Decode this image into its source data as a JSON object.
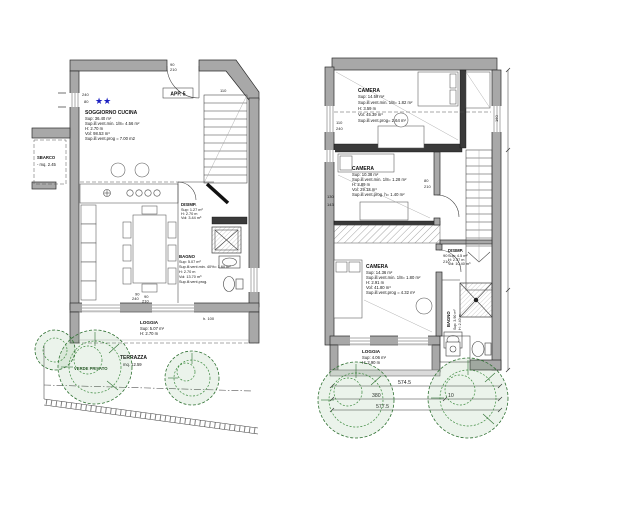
{
  "plan_title": "floor-plan",
  "left_unit": {
    "app_label": "APP. 5",
    "stars": "★★",
    "sbarco": {
      "title": "SBARCO",
      "line": "- mq. 2.45"
    },
    "soggiorno": {
      "title": "SOGGIORNO CUCINA",
      "stats": [
        "Sup: 36.40 m²",
        "Sup.ill.vent.min. 1/8= 4.56 m²",
        "H: 2.70 m",
        "Vol: 98.53 m³",
        "Sup.ill.vent.prog = 7.00 m2"
      ]
    },
    "disimp": {
      "title": "DISIMP.",
      "stats": [
        "Sup: 1.27 m²",
        "H: 2.70 m",
        "Vol: 3.44 m³"
      ]
    },
    "bagno": {
      "title": "BAGNO",
      "stats": [
        "Sup: 5.07 m²",
        "Sup.ill.vent.min. 40%= 1.60 m²",
        "H: 2.70 m",
        "Vol: 13.70 m³",
        "Sup.ill.vent.prog."
      ]
    },
    "loggia": {
      "title": "LOGGIA",
      "stats": [
        "Sup: 5.07 m²",
        "H: 2.70 m"
      ]
    },
    "terrazza": {
      "title": "TERRAZZA",
      "line": "mq. 12.59"
    },
    "verde": "VERDE PRIVATO",
    "dims": {
      "w240": "240",
      "w80": "80",
      "door_w": "90",
      "door_h": "210",
      "stair": "110",
      "win_a": "240",
      "win_b": "90",
      "table_w": "90",
      "table_l": "210",
      "h100": "h. 100"
    }
  },
  "right_unit": {
    "camera_top": {
      "title": "CAMERA",
      "stats": [
        "Sup: 14.59 m²",
        "Sup.ill.vent.min. 1/8= 1.82 m²",
        "H: 3.59 m",
        "Vol: 45.39 m³",
        "Sup.ill.vent.prog= 2.64 m²"
      ]
    },
    "camera_mid": {
      "title": "CAMERA",
      "stats": [
        "Sup: 10.38 m²",
        "Sup.ill.vent.min. 1/8= 1.28 m²",
        "H: 2.89 m",
        "Vol: 29.13 m³",
        "Sup.ill.vent.prog. h= 1.40 m²"
      ]
    },
    "camera_low": {
      "title": "CAMERA",
      "stats": [
        "Sup: 14.36 m²",
        "Sup.ill.vent.min. 1/8= 1.80 m²",
        "H: 2.91 m",
        "Vol: 41.80 m³",
        "Sup.ill.vent.prog = 4.32 m²"
      ]
    },
    "disimp": {
      "title": "DISIMP.",
      "stats": [
        "Sup: 4.5 m²",
        "H: 2.37 m",
        "Vol: 10.40 m³"
      ]
    },
    "bagno": {
      "title": "BAGNO",
      "stats": [
        "Sup: 3.90 m²",
        "H: 2.40 m"
      ]
    },
    "loggia": {
      "title": "LOGGIA",
      "stats": [
        "Sup: 4.06 m²",
        "H: 2.90 m"
      ]
    },
    "dims": {
      "win1_w": "110",
      "win1_h": "240",
      "d130": "130",
      "d143": "143",
      "d80": "80",
      "d210": "210",
      "door_w": "90",
      "door_h": "210",
      "d160": "160",
      "total": "574.5",
      "seg1": "380",
      "seg2": "10",
      "total2": "577.5"
    }
  }
}
